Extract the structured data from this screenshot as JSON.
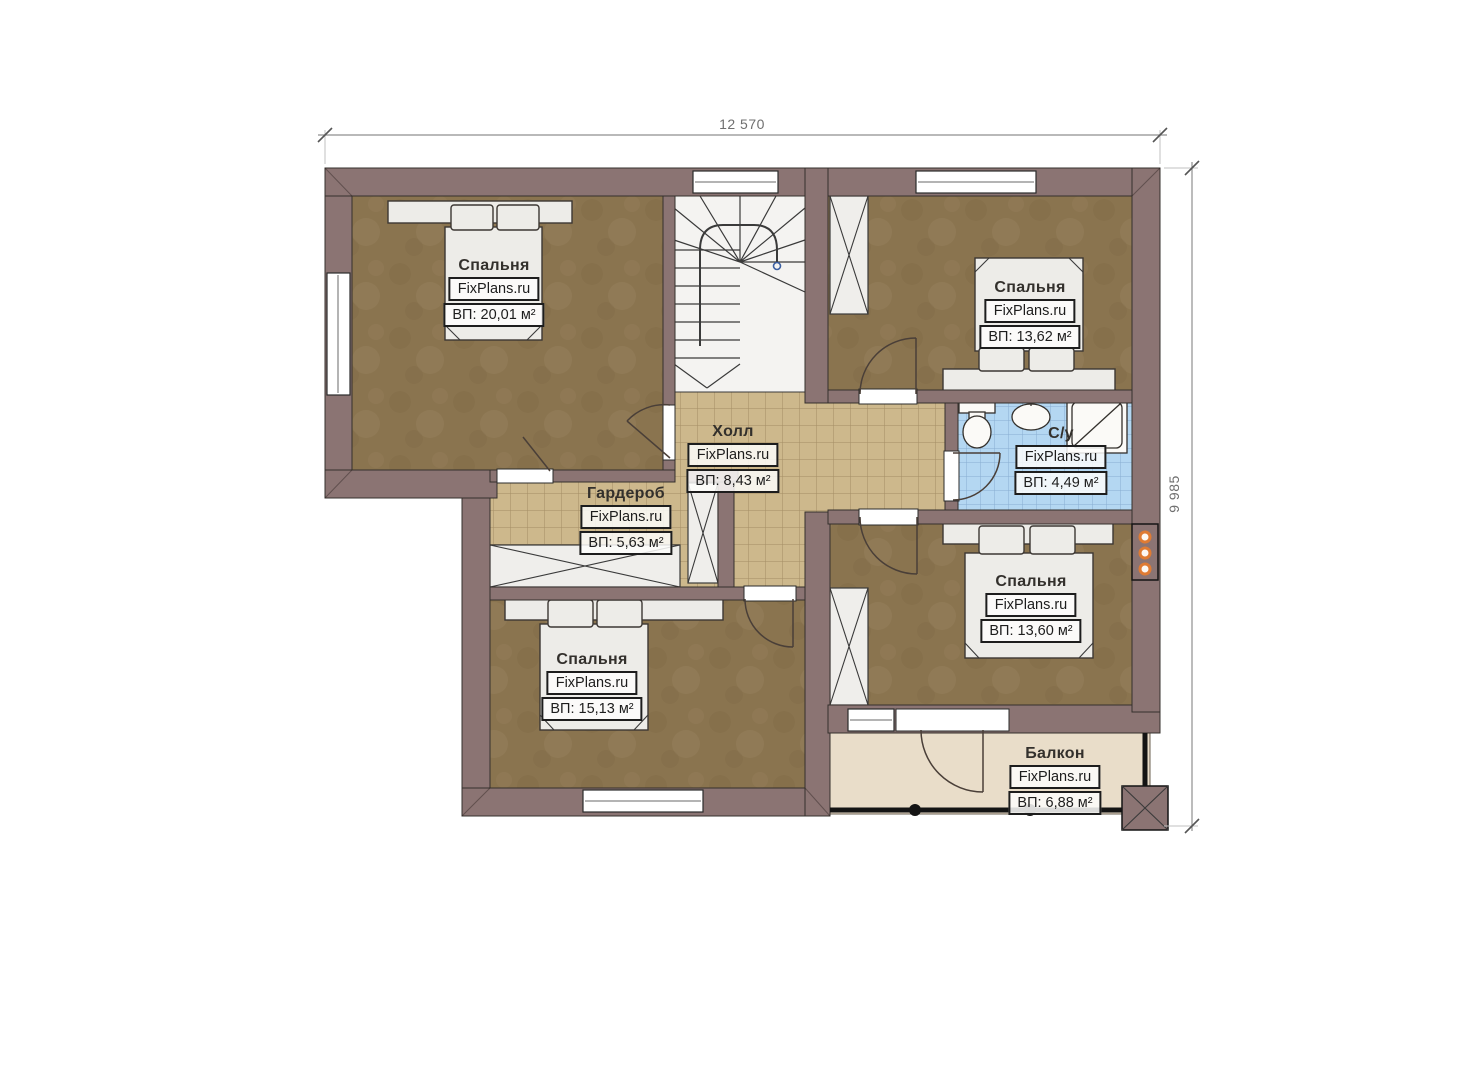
{
  "dimensions": {
    "width_label": "12 570",
    "height_label": "9 985"
  },
  "rooms": {
    "bedroom_top_left": {
      "name": "Спальня",
      "brand": "FixPlans.ru",
      "area": "ВП: 20,01 м²"
    },
    "bedroom_top_right": {
      "name": "Спальня",
      "brand": "FixPlans.ru",
      "area": "ВП: 13,62 м²"
    },
    "hall": {
      "name": "Холл",
      "brand": "FixPlans.ru",
      "area": "ВП: 8,43 м²"
    },
    "wardrobe": {
      "name": "Гардероб",
      "brand": "FixPlans.ru",
      "area": "ВП: 5,63 м²"
    },
    "bathroom": {
      "name": "С/у",
      "brand": "FixPlans.ru",
      "area": "ВП: 4,49 м²"
    },
    "bedroom_right": {
      "name": "Спальня",
      "brand": "FixPlans.ru",
      "area": "ВП: 13,60 м²"
    },
    "bedroom_bottom_left": {
      "name": "Спальня",
      "brand": "FixPlans.ru",
      "area": "ВП: 15,13 м²"
    },
    "balcony": {
      "name": "Балкон",
      "brand": "FixPlans.ru",
      "area": "ВП: 6,88 м²"
    }
  },
  "colors": {
    "wall": "#8b7473",
    "bedroom_floor": "#8a744f",
    "tile_floor": "#cdb88c",
    "bath_floor": "#b4d7f2",
    "balcony_floor": "#e9ddc9",
    "vent_orange": "#df7b33",
    "stair_marker_blue": "#3b5fa2"
  }
}
